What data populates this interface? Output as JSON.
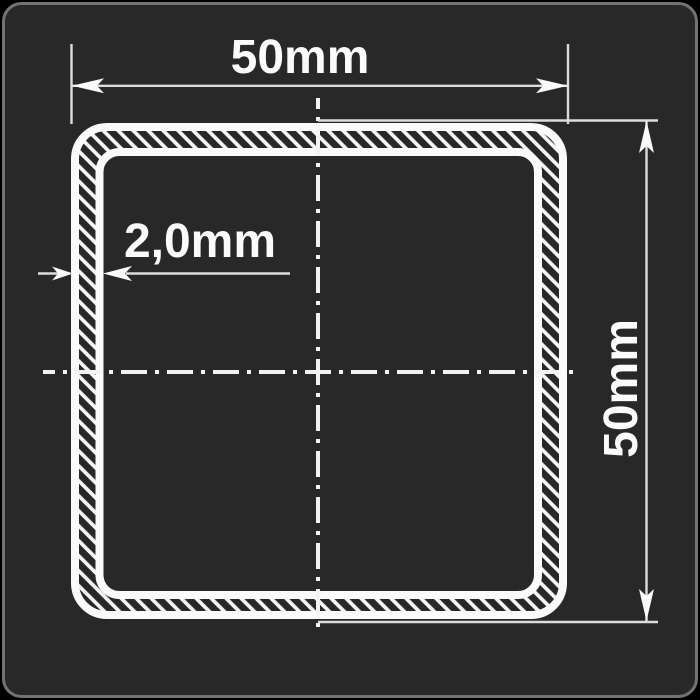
{
  "drawing": {
    "kind": "square-tube-cross-section",
    "labels": {
      "width": "50mm",
      "height": "50mm",
      "thickness": "2,0mm"
    },
    "colors": {
      "page_background": "#000000",
      "panel_background": "#282828",
      "panel_border": "#737373",
      "line_white": "#fafafa",
      "thin_line": "#dcdcdc",
      "centerline": "#f2f2f2"
    }
  }
}
